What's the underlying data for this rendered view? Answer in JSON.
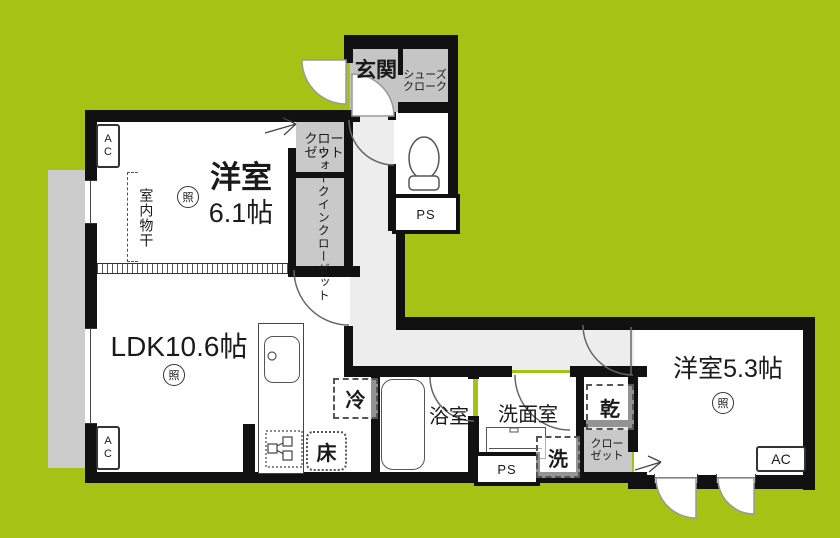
{
  "colors": {
    "background": "#a6c214",
    "wall": "#111111",
    "room_floor": "#ffffff",
    "hall_floor": "#ededed",
    "closet_floor": "#c9c9c9",
    "entrance_floor": "#c5c5c5",
    "balcony_floor": "#cccccc"
  },
  "labels": {
    "entrance": "玄関",
    "shoes_closet_line1": "シューズ",
    "shoes_closet_line2": "クローク",
    "ps": "PS",
    "closet_line1": "クロー",
    "closet_line2": "ゼット",
    "walk_in_closet": "ウォークインクローゼット",
    "bedroom1_name": "洋室",
    "bedroom1_size": "6.1帖",
    "indoor_laundry": "室内物干",
    "ac_line1": "A",
    "ac_line2": "C",
    "ac": "AC",
    "ldk": "LDK10.6帖",
    "light_symbol": "照",
    "refrigerator": "冷",
    "floor_storage": "床",
    "bathroom": "浴室",
    "washroom": "洗面室",
    "washer": "洗",
    "dryer": "乾",
    "bedroom2": "洋室5.3帖"
  }
}
